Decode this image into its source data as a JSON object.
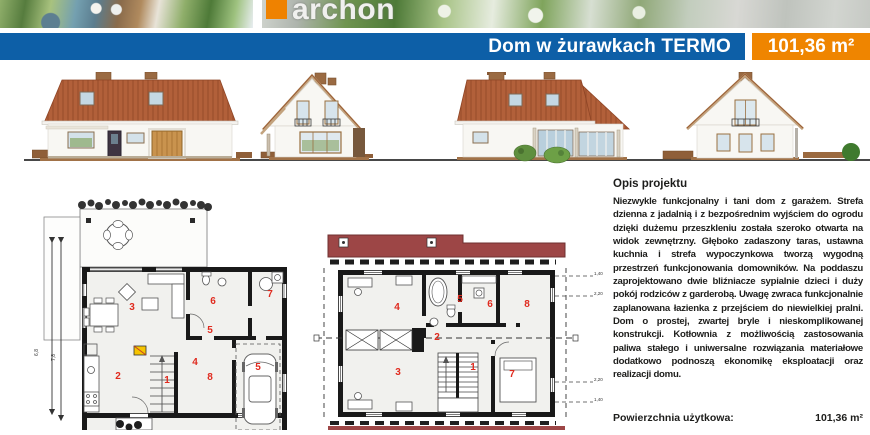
{
  "logo": {
    "text": "archon",
    "square_color": "#ef8200"
  },
  "title_bar": {
    "title": "Dom w żurawkach TERMO",
    "area": "101,36 m²",
    "bar_color": "#0d5fa7",
    "accent_color": "#ef8500"
  },
  "elevations": {
    "items": [
      "front-elevation",
      "left-side-elevation",
      "rear-elevation",
      "right-side-elevation"
    ],
    "roof_color": "#b2603a"
  },
  "plans": {
    "ground_floor": {
      "rooms": [
        "3",
        "6",
        "7",
        "5",
        "2",
        "1",
        "4",
        "8",
        "5"
      ],
      "dims": [
        "6,8",
        "7,8"
      ]
    },
    "first_floor": {
      "rooms": [
        "4",
        "5",
        "6",
        "8",
        "2",
        "3",
        "1",
        "7"
      ],
      "roof_marks": [
        "1,40",
        "2,20",
        "2,20",
        "1,40"
      ],
      "band_color": "#9d4646"
    },
    "room_number_color": "#e02a1e"
  },
  "description": {
    "heading": "Opis projektu",
    "body": "Niezwykle funkcjonalny i tani dom z garażem. Strefa dzienna z jadalnią i z bezpośrednim wyjściem do ogrodu dzięki dużemu przeszkleniu została szeroko otwarta na widok zewnętrzny. Głęboko zadaszony taras, ustawna kuchnia i strefa wypoczynkowa tworzą wygodną przestrzeń funkcjonowania domowników. Na poddaszu zaprojektowano dwie bliźniacze sypialnie dzieci i duży pokój rodziców z garderobą. Uwagę zwraca funkcjonalnie zaplanowana łazienka z przejściem do niewielkiej pralni. Dom o prostej, zwartej bryle i nieskomplikowanej konstrukcji. Kotłownia z możliwością zastosowania paliwa stałego i uniwersalne rozwiązania materiałowe dodatkowo podnoszą ekonomikę eksploatacji oraz realizacji domu."
  },
  "summary": {
    "label": "Powierzchnia użytkowa:",
    "value": "101,36 m²"
  }
}
